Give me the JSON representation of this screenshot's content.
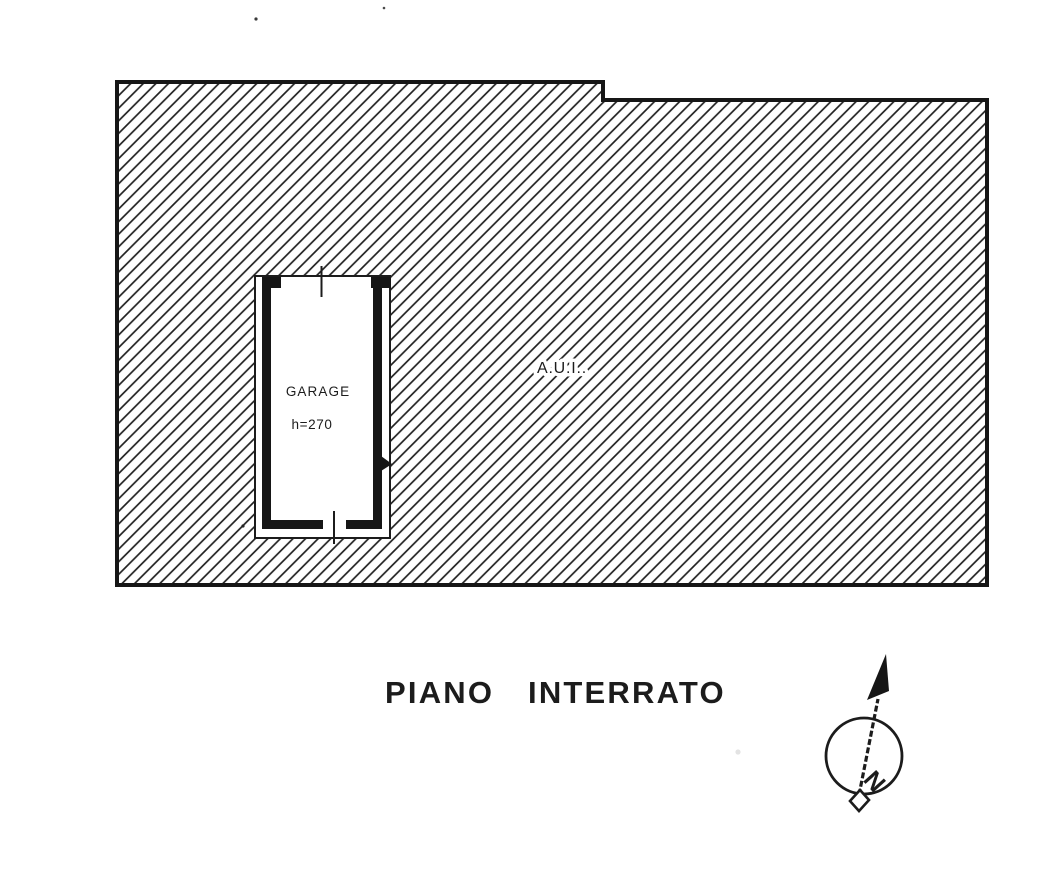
{
  "page": {
    "paper_color": "#ffffff",
    "ink_color": "#1c1c1c",
    "hatch_color": "#222222"
  },
  "plan": {
    "area_label": "A.U.I..",
    "garage": {
      "label": "GARAGE",
      "height": "h=270"
    }
  },
  "caption": {
    "word1": "PIANO",
    "word2": "INTERRATO"
  },
  "compass": {
    "north_letter": "N"
  }
}
